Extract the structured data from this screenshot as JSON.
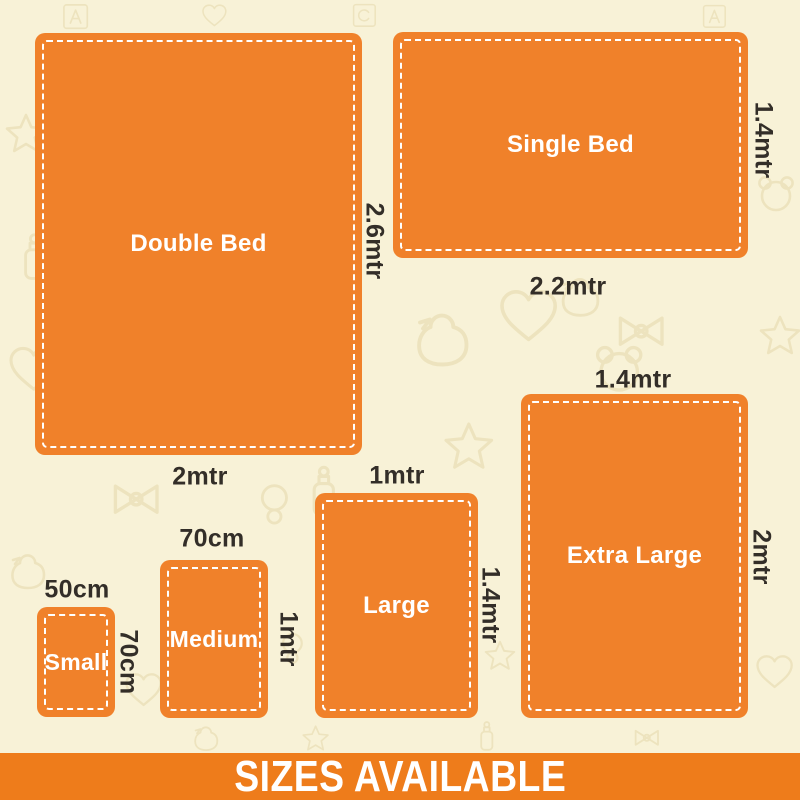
{
  "page": {
    "background_color": "#F8F2D7",
    "pattern_color": "#E3D6A6"
  },
  "box_style": {
    "fill_color": "#F0812A",
    "border": "white-dashed",
    "name_color": "#FFFFFF",
    "dimension_text_color": "#332E28"
  },
  "sizes": [
    {
      "name": "Double Bed",
      "width_label": "2mtr",
      "height_label": "2.6mtr"
    },
    {
      "name": "Single Bed",
      "width_label": "2.2mtr",
      "height_label": "1.4mtr"
    },
    {
      "name": "Extra Large",
      "width_label": "1.4mtr",
      "height_label": "2mtr"
    },
    {
      "name": "Large",
      "width_label": "1mtr",
      "height_label": "1.4mtr"
    },
    {
      "name": "Medium",
      "width_label": "70cm",
      "height_label": "1mtr"
    },
    {
      "name": "Small",
      "width_label": "50cm",
      "height_label": "70cm"
    }
  ],
  "footer": {
    "label": "SIZES AVAILABLE",
    "background_color": "#EE7C1B",
    "text_color": "#FFFFFF"
  },
  "pattern_icons": [
    "duck-icon",
    "heart-icon",
    "star-icon",
    "bottle-icon",
    "teddy-bear-icon",
    "pacifier-icon",
    "bow-icon",
    "alphabet-block-icon"
  ]
}
